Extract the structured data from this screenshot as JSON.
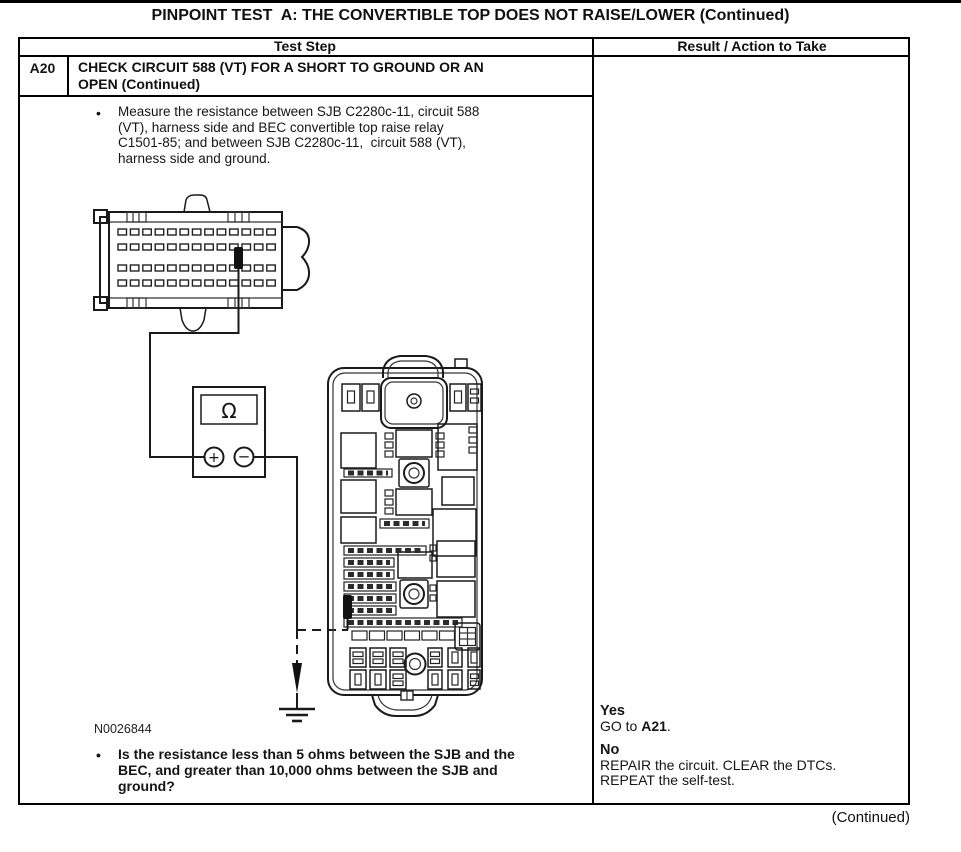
{
  "page": {
    "title": "PINPOINT TEST  A: THE CONVERTIBLE TOP DOES NOT RAISE/LOWER (Continued)",
    "continued": "(Continued)"
  },
  "glyphs": {
    "bullet": "•"
  },
  "table": {
    "headers": {
      "test_step": "Test Step",
      "result": "Result / Action to Take"
    }
  },
  "step": {
    "id": "A20",
    "name_lines": [
      "CHECK CIRCUIT 588 (VT) FOR A SHORT TO GROUND OR AN",
      "OPEN (Continued)"
    ],
    "measure_lines": [
      "Measure the resistance between SJB C2280c-11, circuit 588",
      "(VT), harness side and BEC convertible top raise relay",
      "C1501-85; and between SJB C2280c-11,  circuit 588 (VT),",
      "harness side and ground."
    ],
    "question_lines": [
      "Is the resistance less than 5 ohms between the SJB and the",
      "BEC, and greater than 10,000 ohms between the SJB and",
      "ground?"
    ]
  },
  "figure": {
    "id": "N0026844",
    "ohm_symbol": "Ω",
    "plus_symbol": "+",
    "minus_symbol": "−"
  },
  "result": {
    "yes_label": "Yes",
    "yes_action": {
      "pre": "GO to ",
      "target": "A21",
      "post": "."
    },
    "no_label": "No",
    "no_lines": [
      "REPAIR the circuit. CLEAR the DTCs.",
      "REPEAT the self-test."
    ]
  }
}
